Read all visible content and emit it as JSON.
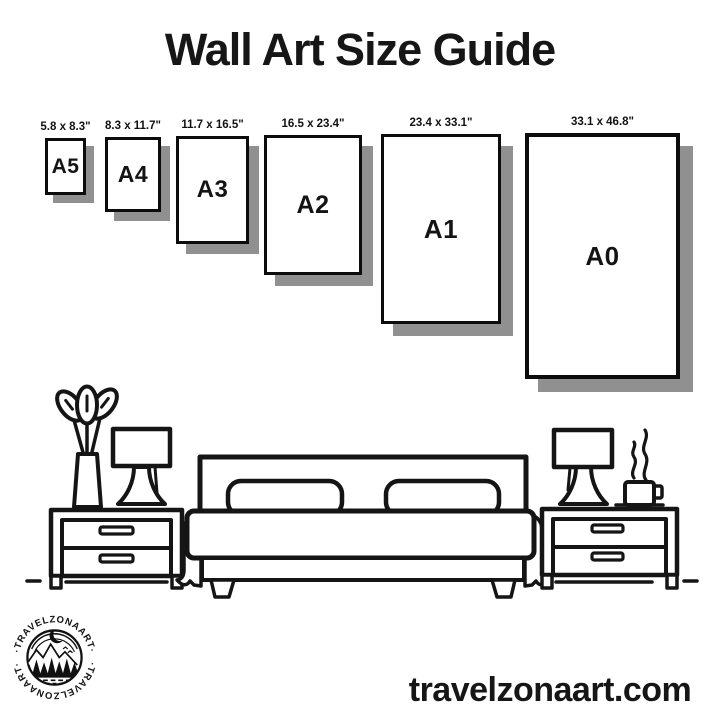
{
  "title": "Wall Art Size Guide",
  "website": "travelzonaart.com",
  "colors": {
    "ink": "#141414",
    "shadow": "#909090",
    "background": "#ffffff"
  },
  "frames": [
    {
      "label": "A5",
      "size": "5.8 x 8.3\""
    },
    {
      "label": "A4",
      "size": "8.3 x 11.7\""
    },
    {
      "label": "A3",
      "size": "11.7 x 16.5\""
    },
    {
      "label": "A2",
      "size": "16.5 x 23.4\""
    },
    {
      "label": "A1",
      "size": "23.4 x 33.1\""
    },
    {
      "label": "A0",
      "size": "33.1 x 46.8\""
    }
  ],
  "logo": {
    "text_top": "·TRAVELZONAART·",
    "text_bottom": "·TRAVELZONAART·"
  },
  "illustration": {
    "name": "bedroom-scene",
    "items": [
      "potted-plant",
      "table-lamp-left",
      "nightstand-left",
      "double-bed",
      "pillow-left",
      "pillow-right",
      "table-lamp-right",
      "coffee-cup-with-steam",
      "nightstand-right",
      "floor-line"
    ]
  }
}
